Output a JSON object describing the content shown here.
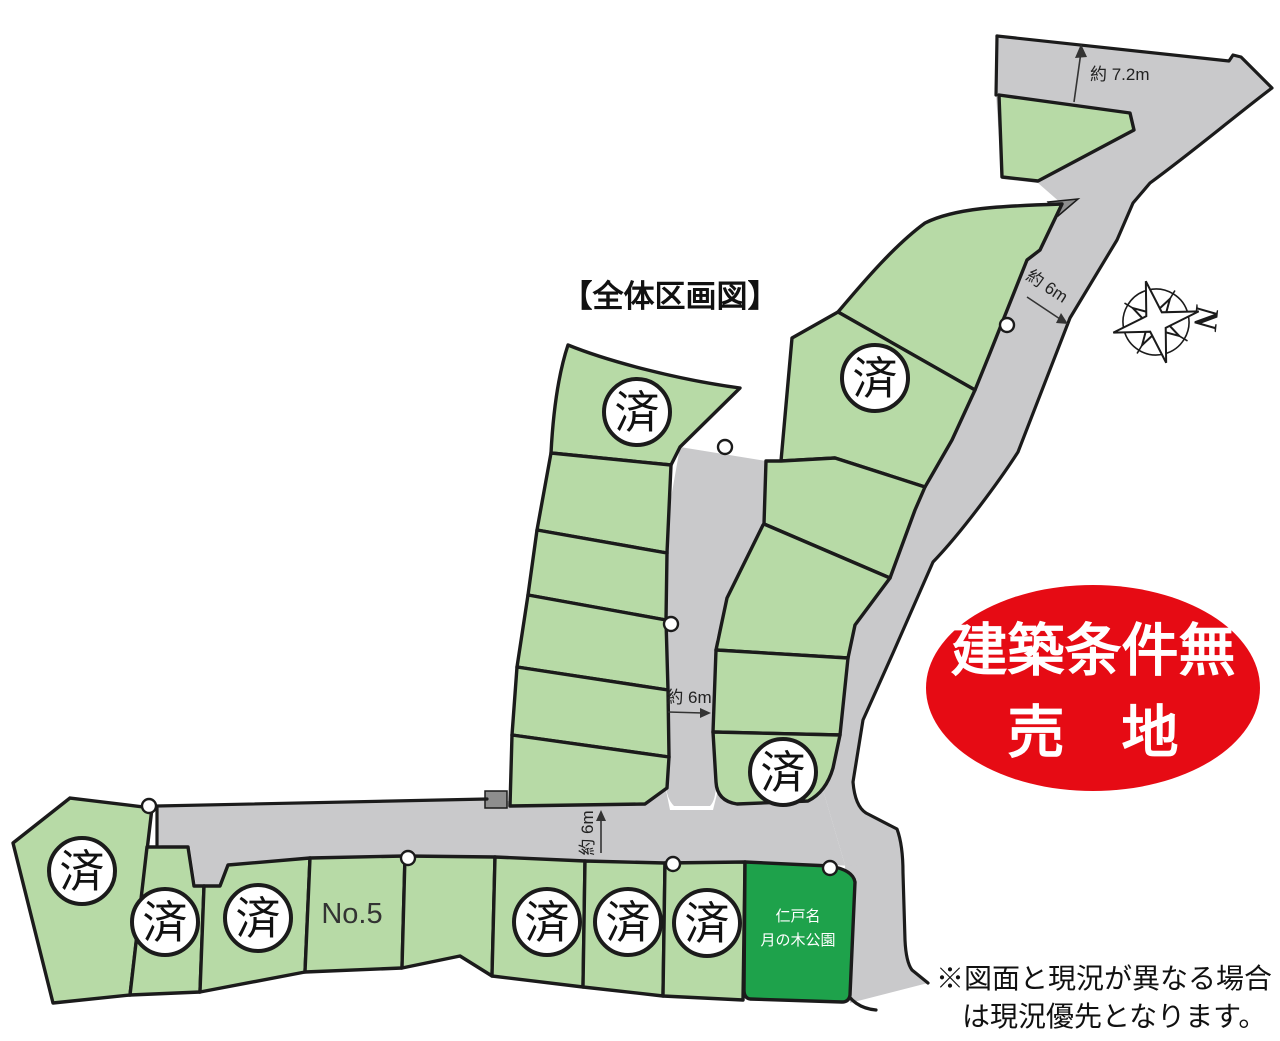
{
  "page": {
    "title": "【全体区画図】"
  },
  "badge": {
    "line1": "建築条件無",
    "line2": "売　地",
    "color": "#e60b14",
    "text_color": "#ffffff"
  },
  "compass": {
    "label": "N"
  },
  "dimensions": {
    "top_road": "約 7.2m",
    "right_road": "約 6m",
    "center_road": "約 6m",
    "bottom_road": "約 6m"
  },
  "lots": {
    "sold_label": "済",
    "no5_label": "No.5",
    "sold_count": 9
  },
  "park": {
    "line1": "仁戸名",
    "line2": "月の木公園",
    "color": "#1ea24b"
  },
  "disclaimer": {
    "line1": "※図面と現況が異なる場合",
    "line2": "は現況優先となります。"
  },
  "colors": {
    "lot_green": "#b7daa6",
    "road_gray": "#c9c9cb",
    "outline_black": "#1b1b1b"
  }
}
